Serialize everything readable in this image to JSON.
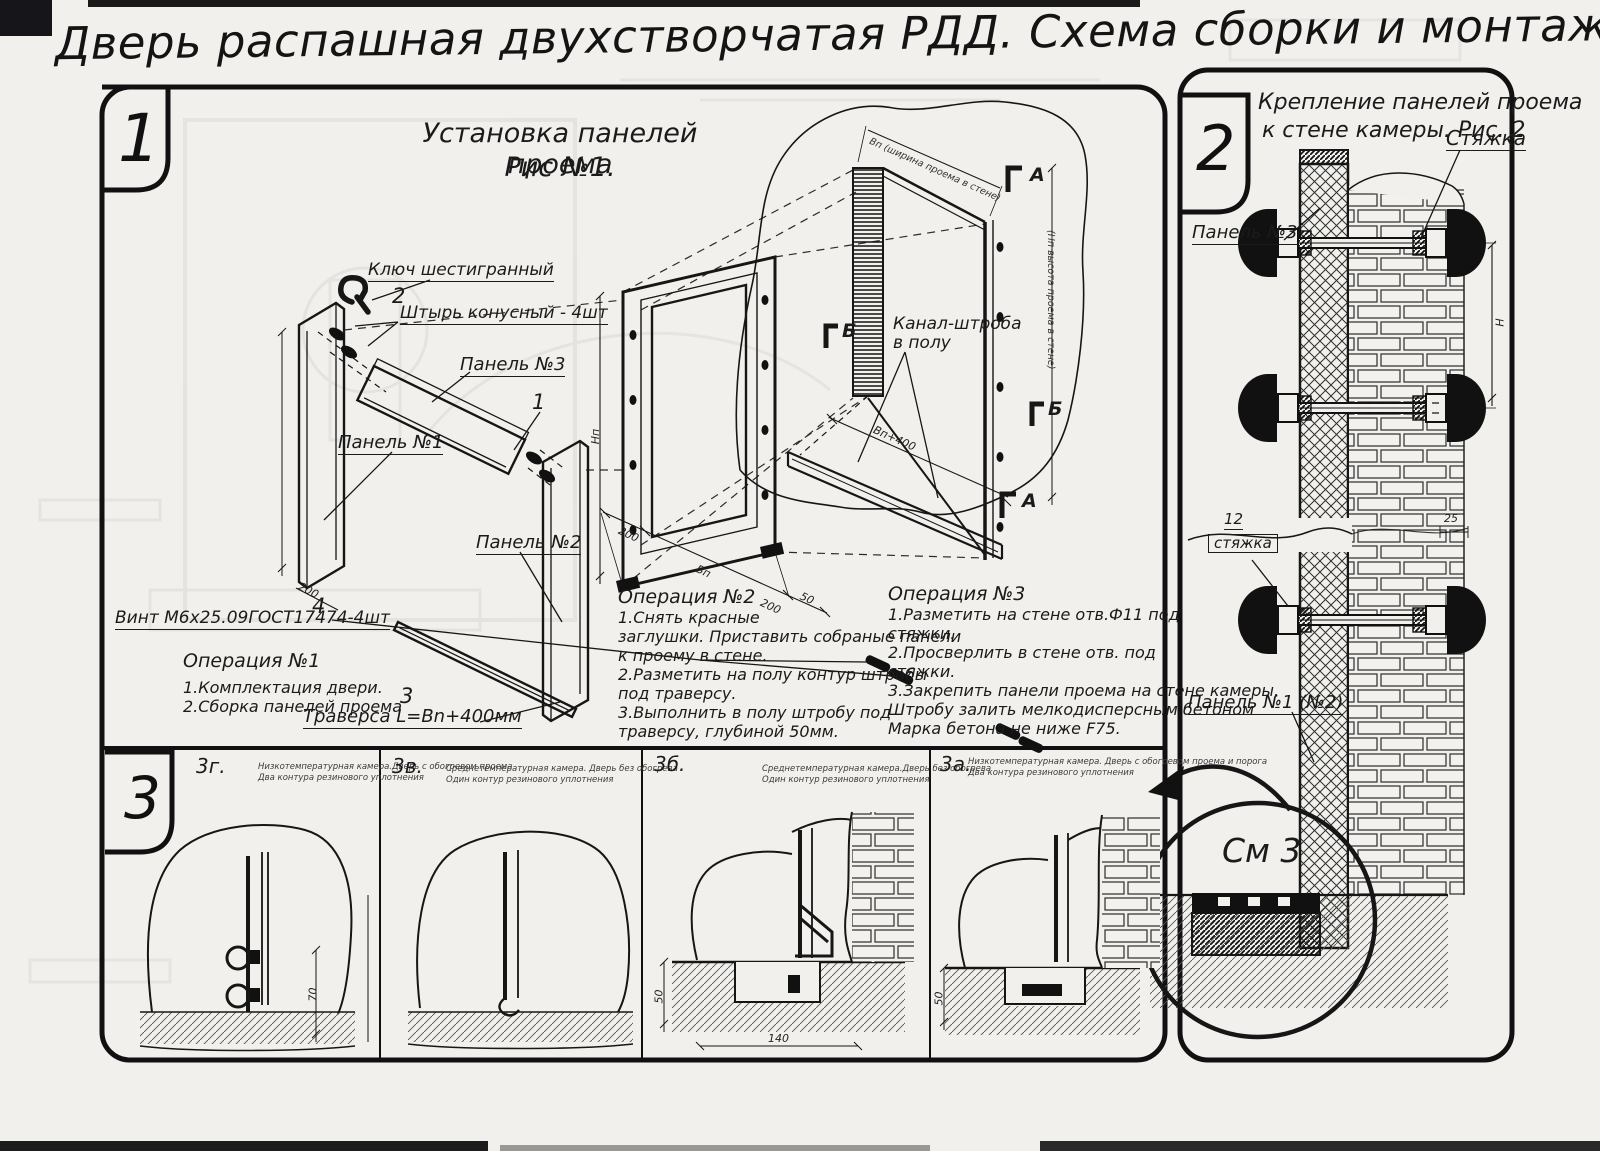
{
  "title": "Дверь распашная двухстворчатая РДД.  Схема сборки и монтажа №2",
  "tabs": {
    "t1": "1",
    "t2": "2",
    "t3": "3"
  },
  "panel1": {
    "fig_title_1": "Установка панелей проема",
    "fig_title_2": "Рис №1.",
    "items": {
      "i1": "1",
      "i2": "2",
      "i3": "3",
      "i4": "4"
    },
    "markers": {
      "a": "А",
      "b": "Б"
    },
    "labels": {
      "hex_key": "Ключ шестигранный",
      "pin": "Штырь конусный - 4шт",
      "panel3": "Панель №3",
      "panel1": "Панель №1",
      "panel2": "Панель №2",
      "screw": "Винт М6х25.09ГОСТ17474-4шт",
      "traverse": "Траверса  L=Bn+400мм",
      "channel_1": "Канал-штроба",
      "channel_2": "в полу"
    },
    "dims": {
      "d200": "200",
      "np": "Нп",
      "bp": "Вп",
      "d50": "50",
      "bp400": "Вп+400",
      "top_width": "Вп (ширина проема в стене)",
      "wall_height": "(Нп высота проема в стене)"
    },
    "op1": {
      "title": "Операция №1",
      "l1": "1.Комплектация двери.",
      "l2": "2.Сборка панелей проема"
    },
    "op2": {
      "title": "Операция №2",
      "l1": "1.Снять красные",
      "l2": "заглушки. Приставить собраные панели",
      "l3": "к проему в стене.",
      "l4": "2.Разметить на полу контур штробы",
      "l5": "под траверсу.",
      "l6": "3.Выполнить в полу штробу под",
      "l7": "траверсу, глубиной 50мм."
    },
    "op3": {
      "title": "Операция №3",
      "l1": "1.Разметить на стене отв.Ф11 под",
      "l2": "стяжки.",
      "l3": "2.Просверлить в стене отв.  под",
      "l4": "стяжки.",
      "l5": "3.Закрепить панели проема на стене камеры.",
      "l6": "Штробу залить мелкодисперсным бетоном",
      "l7": "Марка бетона не ниже  F75."
    }
  },
  "panel2": {
    "fig_title_1": "Крепление панелей проема",
    "fig_title_2": "к стене камеры. Рис. 2",
    "labels": {
      "tie": "Стяжка",
      "panel3": "Панель №3",
      "tie_item": "12",
      "tie_word": "стяжка",
      "panel12": "Панель №1 (№2)",
      "see": "См 3"
    },
    "dims": {
      "d25": "25",
      "h": "Н"
    }
  },
  "panel3": {
    "sections": [
      {
        "id": "3г.",
        "c1": "Низкотемпературная камера.Дверь с обогревом проема",
        "c2": "Два контура резинового уплотнения",
        "dim": "70"
      },
      {
        "id": "3в.",
        "c1": "Среднетемпературная камера. Дверь без обогрева",
        "c2": "Один контур резинового уплотнения"
      },
      {
        "id": "3б.",
        "c1": "Среднетемпературная камера.Дверь без обогрева",
        "c2": "Один контур резинового уплотнения",
        "dim_v": "50",
        "dim_h": "140"
      },
      {
        "id": "3а.",
        "c1": "Низкотемпературная камера. Дверь с обогревом проема и порога",
        "c2": "Два контура резинового уплотнения",
        "dim_v": "50"
      }
    ]
  }
}
